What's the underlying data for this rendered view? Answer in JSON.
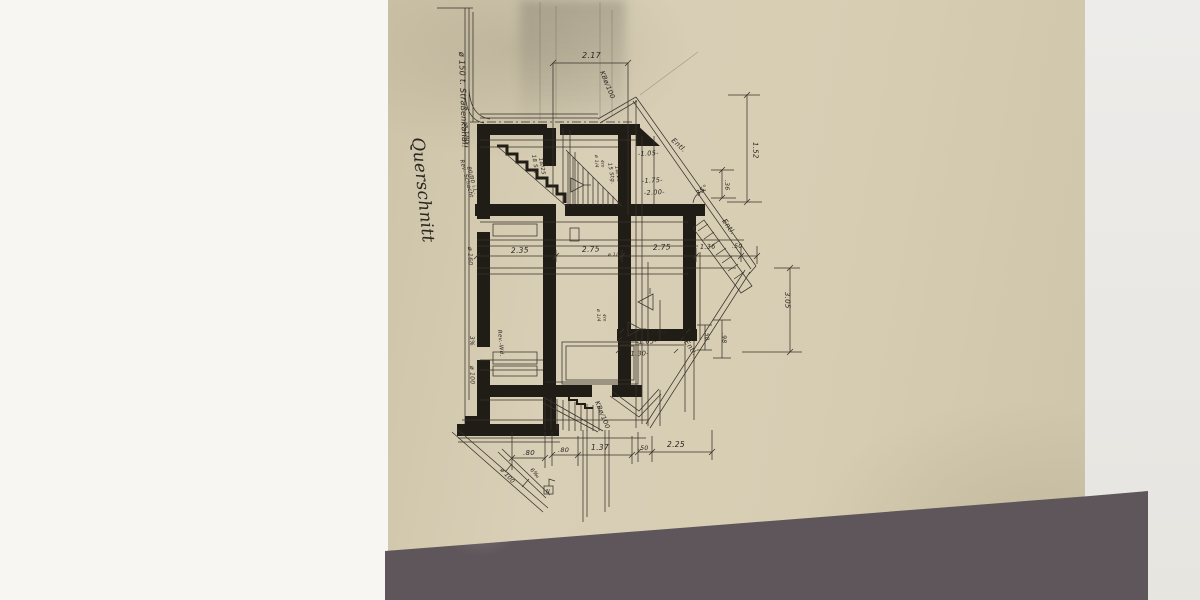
{
  "scene": "photograph of an old hand-drawn architectural cross-section drawing on beige paper lying on a grey marble surface",
  "drawing_title": "Querschnitt",
  "colors": {
    "paper": "#d7cdb3",
    "ink": "#2a251f",
    "marble": "#5e565a",
    "background_left": "#f7f6f2",
    "background_right": "#eceae6"
  },
  "annotations": [
    {
      "t": "ø 150 t. Straßenkanal!",
      "x": 459,
      "y": 52,
      "r": 88,
      "s": 8
    },
    {
      "t": "ø 180",
      "x": 464,
      "y": 124,
      "r": 88,
      "s": 6.5
    },
    {
      "t": "Rev.-Schacht",
      "x": 460,
      "y": 160,
      "r": 75,
      "s": 5.5
    },
    {
      "t": "80/80 i.L.",
      "x": 467,
      "y": 167,
      "r": 75,
      "s": 5.5
    },
    {
      "t": "Querschnitt",
      "x": 412,
      "y": 138,
      "r": 84,
      "s": 17,
      "f": "script"
    },
    {
      "t": "2.17",
      "x": 582,
      "y": 58,
      "r": 0,
      "s": 8
    },
    {
      "t": "KBø/100",
      "x": 600,
      "y": 72,
      "r": 68,
      "s": 6.5
    },
    {
      "t": "Entl.",
      "x": 671,
      "y": 141,
      "r": 42,
      "s": 7
    },
    {
      "t": "-1.05-",
      "x": 638,
      "y": 156,
      "r": -3,
      "s": 6.5
    },
    {
      "t": "-1.75-",
      "x": 642,
      "y": 183,
      "r": -3,
      "s": 6.5
    },
    {
      "t": "-2.00-",
      "x": 644,
      "y": 195,
      "r": -3,
      "s": 6.5
    },
    {
      "t": "18 Stg.",
      "x": 532,
      "y": 155,
      "r": 80,
      "s": 5.5
    },
    {
      "t": "18/25",
      "x": 539,
      "y": 158,
      "r": 80,
      "s": 5.5
    },
    {
      "t": "15 Stg.",
      "x": 608,
      "y": 163,
      "r": 80,
      "s": 5.5
    },
    {
      "t": "18/25",
      "x": 615,
      "y": 166,
      "r": 80,
      "s": 5.5
    },
    {
      "t": "ø 1/4",
      "x": 595,
      "y": 155,
      "r": 88,
      "s": 4.5
    },
    {
      "t": "4m",
      "x": 601,
      "y": 160,
      "r": 88,
      "s": 4.5
    },
    {
      "t": "1.52",
      "x": 753,
      "y": 142,
      "r": 88,
      "s": 7
    },
    {
      "t": ".36",
      "x": 725,
      "y": 180,
      "r": 88,
      "s": 6
    },
    {
      "t": "35°",
      "x": 698,
      "y": 196,
      "r": -38,
      "s": 7
    },
    {
      "t": "Entl.",
      "x": 722,
      "y": 221,
      "r": 55,
      "s": 7
    },
    {
      "t": "2.35",
      "x": 511,
      "y": 253,
      "r": -2,
      "s": 7.5
    },
    {
      "t": "2.75",
      "x": 582,
      "y": 252,
      "r": -2,
      "s": 7.5
    },
    {
      "t": "ø 1/2",
      "x": 608,
      "y": 256,
      "r": 0,
      "s": 4.5
    },
    {
      "t": "2.75",
      "x": 653,
      "y": 250,
      "r": -2,
      "s": 7.5
    },
    {
      "t": "1.36",
      "x": 700,
      "y": 249,
      "r": -2,
      "s": 6.5
    },
    {
      "t": ".50",
      "x": 732,
      "y": 248,
      "r": 0,
      "s": 6
    },
    {
      "t": "3.05",
      "x": 785,
      "y": 292,
      "r": 88,
      "s": 7
    },
    {
      "t": "-2.00-",
      "x": 648,
      "y": 335,
      "r": -2,
      "s": 6.5
    },
    {
      "t": "-1.65-",
      "x": 636,
      "y": 344,
      "r": -2,
      "s": 6.5
    },
    {
      "t": "-1.30-",
      "x": 628,
      "y": 356,
      "r": -2,
      "s": 6.5
    },
    {
      "t": "Entl.",
      "x": 684,
      "y": 342,
      "r": 55,
      "s": 7
    },
    {
      "t": ".50",
      "x": 705,
      "y": 331,
      "r": 88,
      "s": 5.5
    },
    {
      "t": ".98",
      "x": 722,
      "y": 333,
      "r": 88,
      "s": 6
    },
    {
      "t": "ø 1/4",
      "x": 597,
      "y": 309,
      "r": 88,
      "s": 4.5
    },
    {
      "t": "4m",
      "x": 603,
      "y": 314,
      "r": 88,
      "s": 4.5
    },
    {
      "t": "ø 160",
      "x": 468,
      "y": 247,
      "r": 88,
      "s": 6
    },
    {
      "t": "3%",
      "x": 470,
      "y": 336,
      "r": 88,
      "s": 6
    },
    {
      "t": "ø 100",
      "x": 470,
      "y": 366,
      "r": 88,
      "s": 6
    },
    {
      "t": "Rev.-Wd.",
      "x": 498,
      "y": 330,
      "r": 85,
      "s": 5.5
    },
    {
      "t": "KBø/100",
      "x": 595,
      "y": 402,
      "r": 68,
      "s": 6.5
    },
    {
      "t": ".80",
      "x": 523,
      "y": 455,
      "r": 0,
      "s": 7
    },
    {
      "t": ".80",
      "x": 558,
      "y": 452,
      "r": 0,
      "s": 6.5
    },
    {
      "t": "1.37",
      "x": 591,
      "y": 450,
      "r": 0,
      "s": 7.5
    },
    {
      "t": ".50",
      "x": 638,
      "y": 450,
      "r": 0,
      "s": 6
    },
    {
      "t": "2.25",
      "x": 667,
      "y": 447,
      "r": 0,
      "s": 7.5
    },
    {
      "t": "ø 100",
      "x": 500,
      "y": 470,
      "r": 48,
      "s": 6
    },
    {
      "t": "6‰",
      "x": 530,
      "y": 470,
      "r": 48,
      "s": 5.5
    },
    {
      "t": "N",
      "x": 546,
      "y": 493,
      "r": 0,
      "s": 5
    }
  ]
}
